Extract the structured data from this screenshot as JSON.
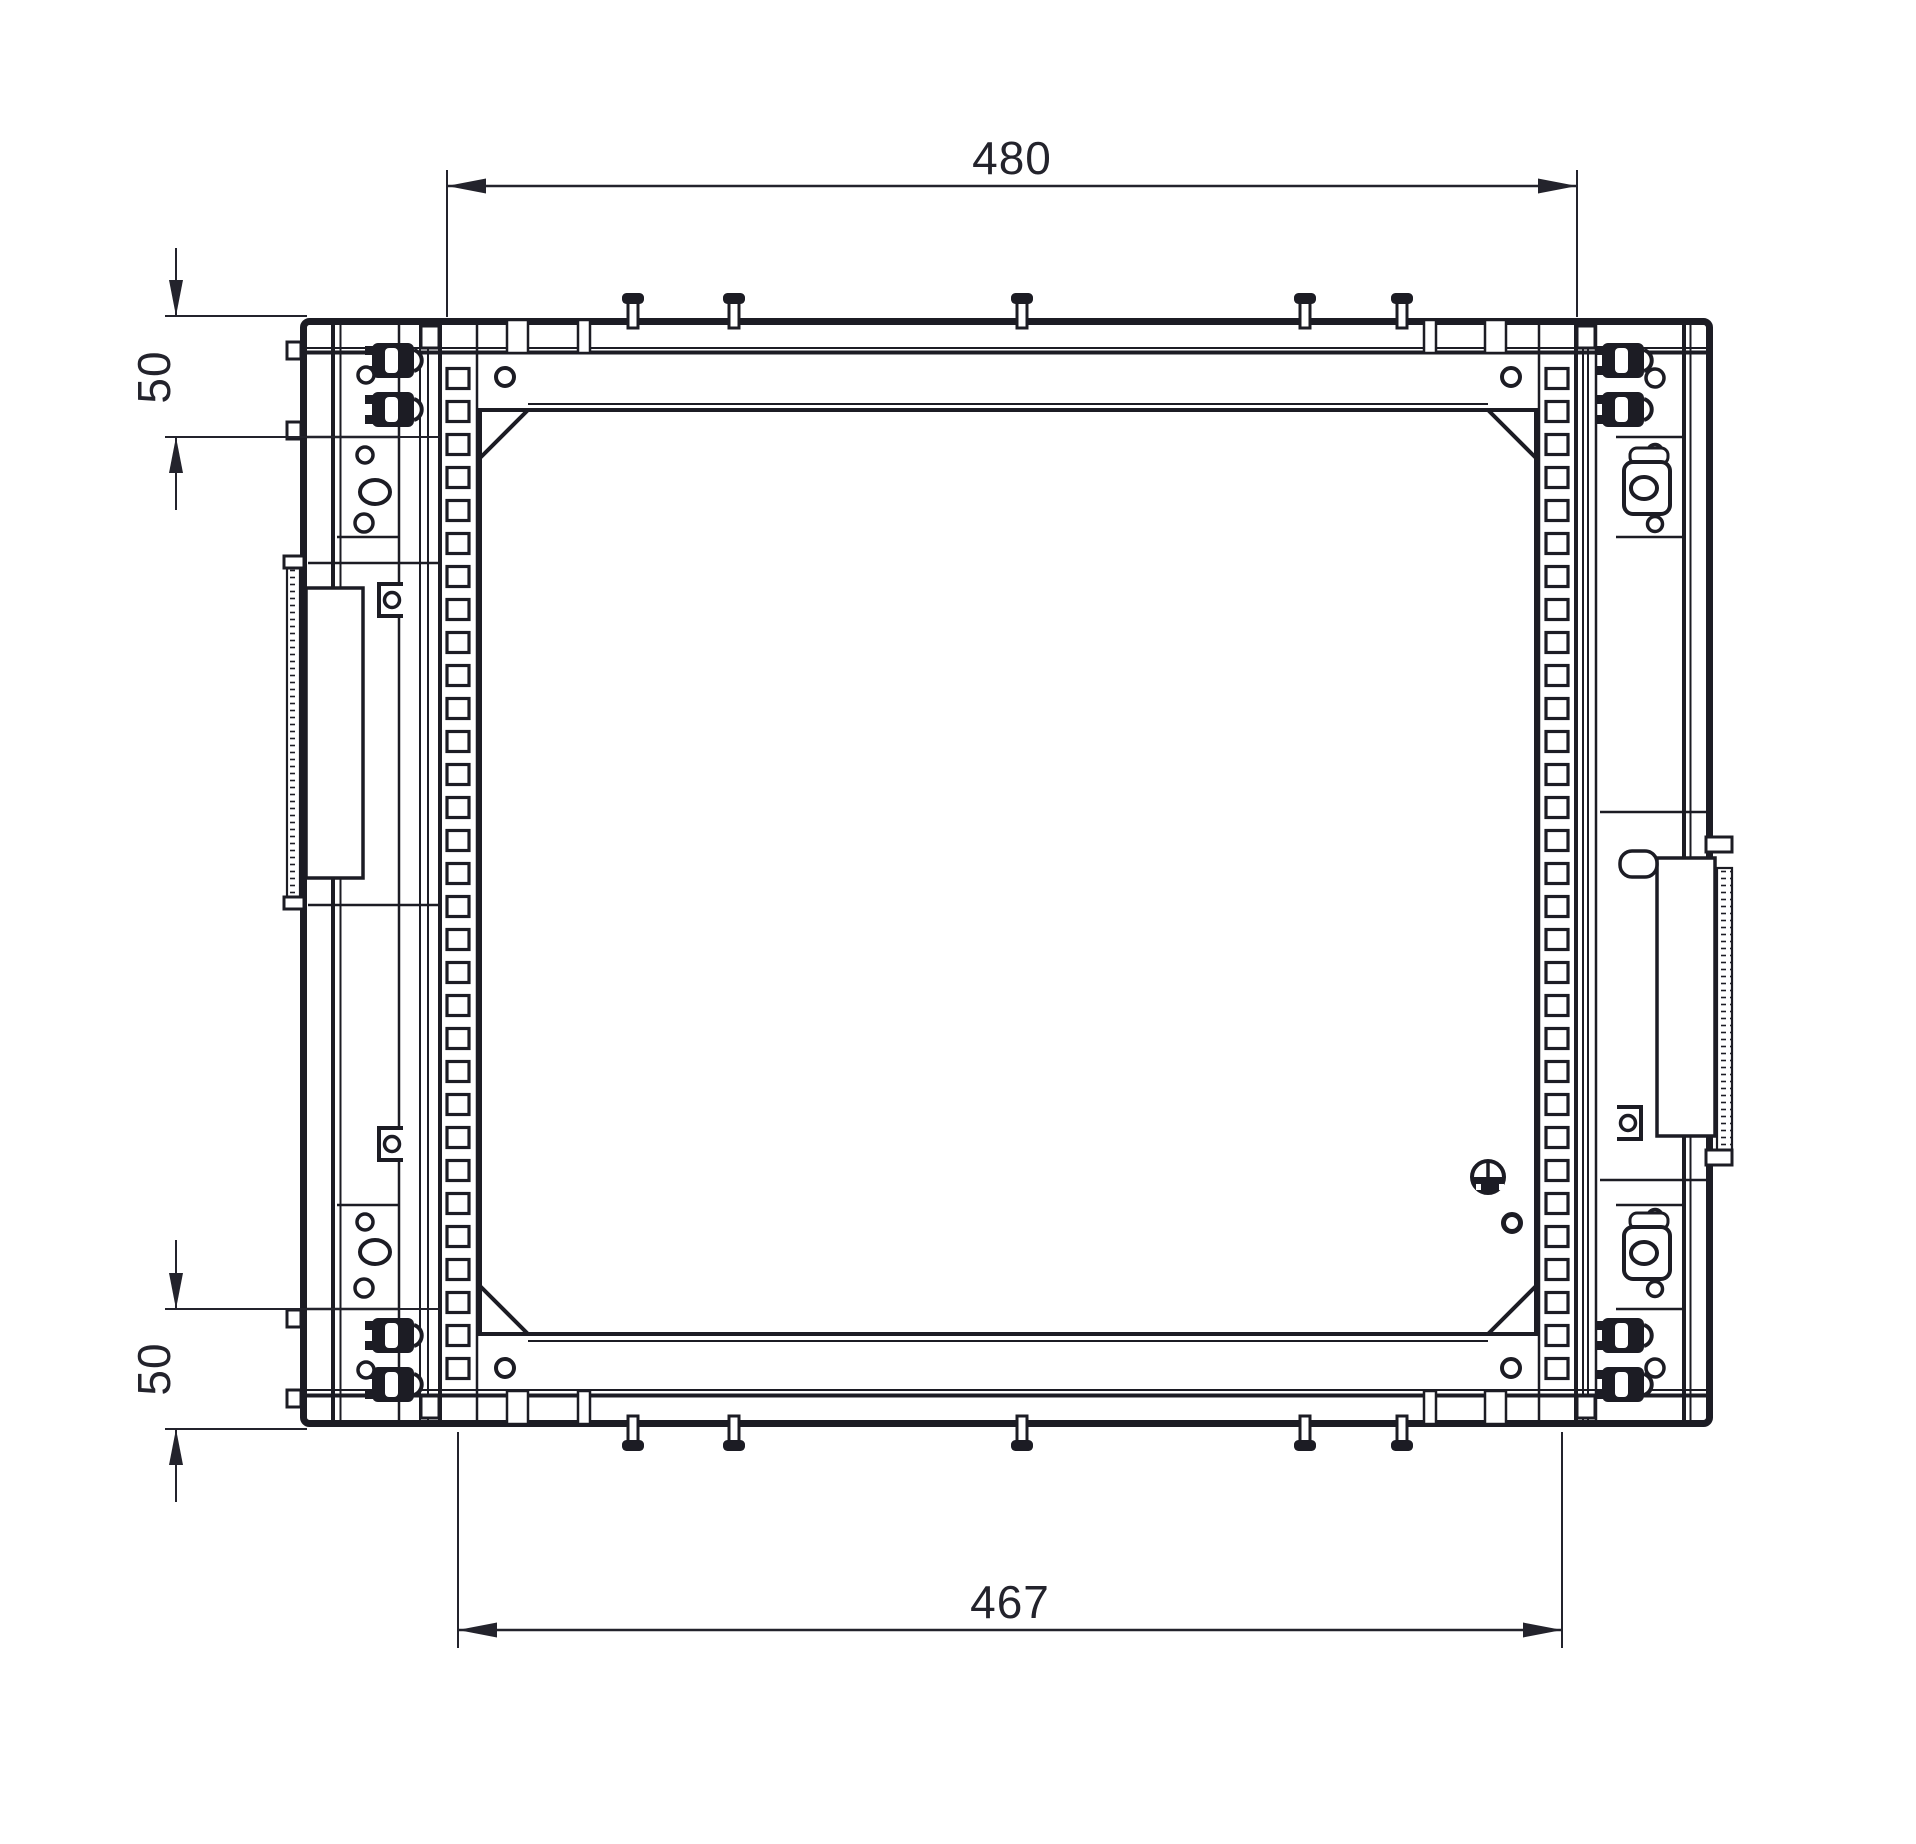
{
  "drawing": {
    "background_color": "#ffffff",
    "line_color": "#1c1c24",
    "dimension_color": "#23232c",
    "dimensions": {
      "overall_width": {
        "value": "480",
        "orientation": "horizontal",
        "position": "top"
      },
      "inner_width": {
        "value": "467",
        "orientation": "horizontal",
        "position": "bottom"
      },
      "top_offset": {
        "value": "50",
        "orientation": "vertical",
        "position": "left-top"
      },
      "bottom_offset": {
        "value": "50",
        "orientation": "vertical",
        "position": "left-bottom"
      }
    }
  }
}
